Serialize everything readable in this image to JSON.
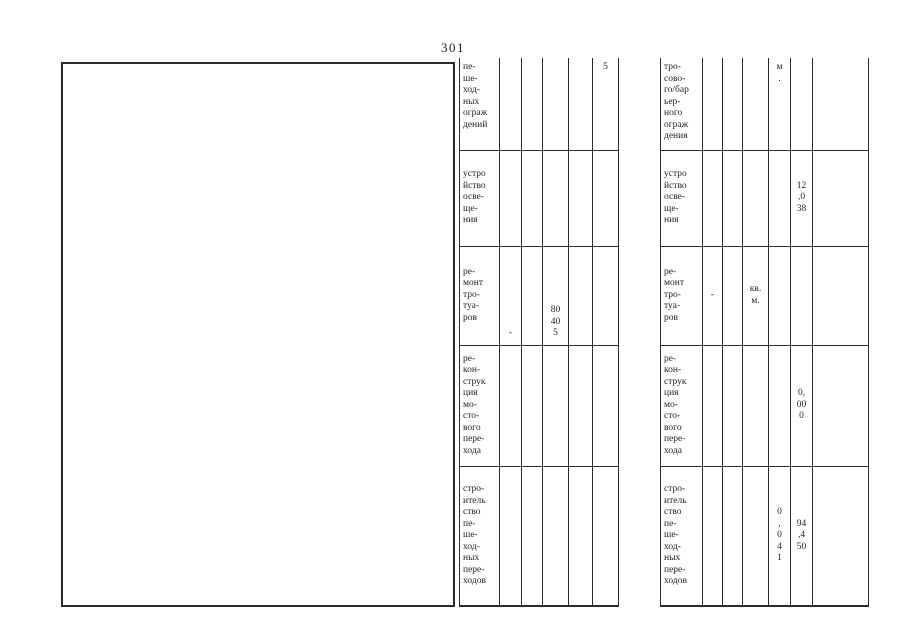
{
  "page": {
    "number": "301"
  },
  "left_table": {
    "rows": [
      {
        "cells": [
          "пе-\nше-\nход-\nных\nограж\nдений",
          "",
          "",
          "",
          "",
          "5"
        ]
      },
      {
        "cells": [
          "устро\nйство\nосве-\nще-\nния",
          "",
          "",
          "",
          "",
          ""
        ]
      },
      {
        "cells": [
          "ре-\nмонт\nтро-\nтуа-\nров",
          "-",
          "",
          "80\n40\n5",
          "",
          ""
        ]
      },
      {
        "cells": [
          "ре-\nкон-\nструк\nция\nмо-\nсто-\nвого\nпере-\nхода",
          "",
          "",
          "",
          "",
          ""
        ]
      },
      {
        "cells": [
          "стро-\nитель\nство\nпе-\nше-\nход-\nных\nпере-\nходов",
          "",
          "",
          "",
          "",
          ""
        ]
      }
    ]
  },
  "right_table": {
    "rows": [
      {
        "cells": [
          "тро-\nсово-\nго/бар\nьер-\nного\nограж\nдения",
          "",
          "",
          "",
          "м\n.",
          "",
          ""
        ]
      },
      {
        "cells": [
          "устро\nйство\nосве-\nще-\nния",
          "",
          "",
          "",
          "",
          "12\n,0\n38",
          ""
        ]
      },
      {
        "cells": [
          "ре-\nмонт\nтро-\nтуа-\nров",
          "-",
          "",
          "кв.\nм.",
          "",
          "",
          ""
        ]
      },
      {
        "cells": [
          "ре-\nкон-\nструк\nция\nмо-\nсто-\nвого\nпере-\nхода",
          "",
          "",
          "",
          "",
          "0,\n00\n0",
          ""
        ]
      },
      {
        "cells": [
          "стро-\nитель\nство\nпе-\nше-\nход-\nных\nпере-\nходов",
          "",
          "",
          "",
          "0\n,\n0\n4\n1",
          "94\n,4\n50",
          ""
        ]
      }
    ]
  }
}
